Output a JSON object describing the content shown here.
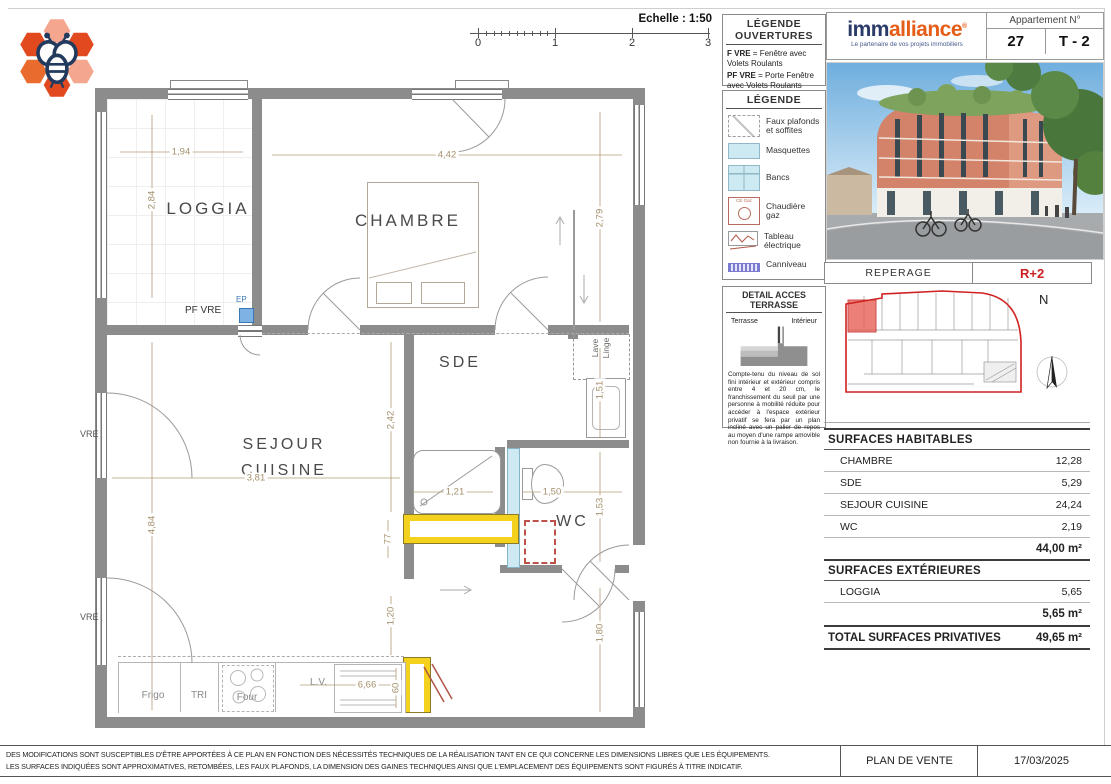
{
  "scale": {
    "label": "Echelle : 1:50",
    "ticks": [
      "0",
      "1",
      "2",
      "3"
    ]
  },
  "legend_ouvertures": {
    "title_line1": "LÉGENDE",
    "title_line2": "OUVERTURES",
    "items": [
      {
        "abbr": "F VRE",
        "desc": "= Fenêtre avec Volets Roulants"
      },
      {
        "abbr": "PF VRE",
        "desc": "= Porte Fenêtre avec Volets Roulants"
      }
    ]
  },
  "legend": {
    "title": "LÉGENDE",
    "items": [
      {
        "label": "Faux plafonds et soffites"
      },
      {
        "label": "Masquettes"
      },
      {
        "label": "Bancs"
      },
      {
        "label": "Chaudière gaz",
        "icon_text": "CE Gaz"
      },
      {
        "label": "Tableau électrique"
      },
      {
        "label": "Canniveau"
      }
    ]
  },
  "detail_terrasse": {
    "title": "DETAIL ACCES TERRASSE",
    "label_terrasse": "Terrasse",
    "label_interieur": "Intérieur",
    "text": "Compte-tenu du niveau de sol fini intérieur et extérieur compris entre 4 et 20 cm, le franchissement du seuil par une personne à mobilité réduite pour accéder à l'espace extérieur privatif se fera par un plan incliné avec un palier de repos au moyen d'une rampe amovible non fournie à la livraison."
  },
  "header": {
    "brand_part1": "imm",
    "brand_part2": "alliance",
    "brand_reg": "®",
    "tagline": "Le partenaire de vos projets immobiliers",
    "apartment_label": "Appartement N°",
    "apartment_number": "27",
    "apartment_type": "T - 2"
  },
  "reperage": {
    "label": "REPERAGE",
    "floor": "R+2",
    "north": "N"
  },
  "plan": {
    "rooms": {
      "loggia": "LOGGIA",
      "chambre": "CHAMBRE",
      "sde": "SDE",
      "sejour_line1": "SEJOUR",
      "sejour_line2": "CUISINE",
      "wc": "WC"
    },
    "dims": {
      "loggia_w": "1,94",
      "loggia_h": "2,84",
      "chambre_w": "4,42",
      "chambre_h": "2,79",
      "sde_h": "2,42",
      "nook_h": "1,51",
      "shower_w": "1,21",
      "wc_w": "1,50",
      "wc_h": "1,53",
      "sejour_w": "3,81",
      "sejour_h": "4,84",
      "hall_w": "77",
      "kitchen_h": "1,20",
      "entry_h": "1,80",
      "counter_w": "6,66",
      "counter_d": "60"
    },
    "labels": {
      "pf_vre": "PF VRE",
      "ep": "EP",
      "vre_top": "VRE",
      "vre_bottom": "VRE",
      "lave": "Lave",
      "linge": "Linge",
      "frigo": "Frigo",
      "tri": "TRI",
      "four": "Four",
      "lv": "L.V."
    }
  },
  "surfaces": {
    "habitables_title": "SURFACES HABITABLES",
    "habitables": [
      {
        "room": "CHAMBRE",
        "area": "12,28"
      },
      {
        "room": "SDE",
        "area": "5,29"
      },
      {
        "room": "SEJOUR CUISINE",
        "area": "24,24"
      },
      {
        "room": "WC",
        "area": "2,19"
      }
    ],
    "habitables_total": "44,00 m²",
    "exterieures_title": "SURFACES EXTÉRIEURES",
    "exterieures": [
      {
        "room": "LOGGIA",
        "area": "5,65"
      }
    ],
    "exterieures_total": "5,65 m²",
    "total_label": "TOTAL SURFACES PRIVATIVES",
    "total_value": "49,65 m²"
  },
  "footer": {
    "line1": "DES MODIFICATIONS SONT SUSCEPTIBLES D'ÊTRE APPORTÉES À CE PLAN EN FONCTION DES NÉCESSITÉS TECHNIQUES DE LA RÉALISATION TANT EN CE QUI CONCERNE LES DIMENSIONS LIBRES QUE LES ÉQUIPEMENTS.",
    "line2": "LES SURFACES INDIQUÉES SONT APPROXIMATIVES, RETOMBÉES, LES FAUX PLAFONDS, LA DIMENSION DES GAINES TECHNIQUES AINSI QUE L'EMPLACEMENT DES ÉQUIPEMENTS SONT FIGURÉS À TITRE INDICATIF.",
    "doc_type": "PLAN DE VENTE",
    "date": "17/03/2025"
  }
}
